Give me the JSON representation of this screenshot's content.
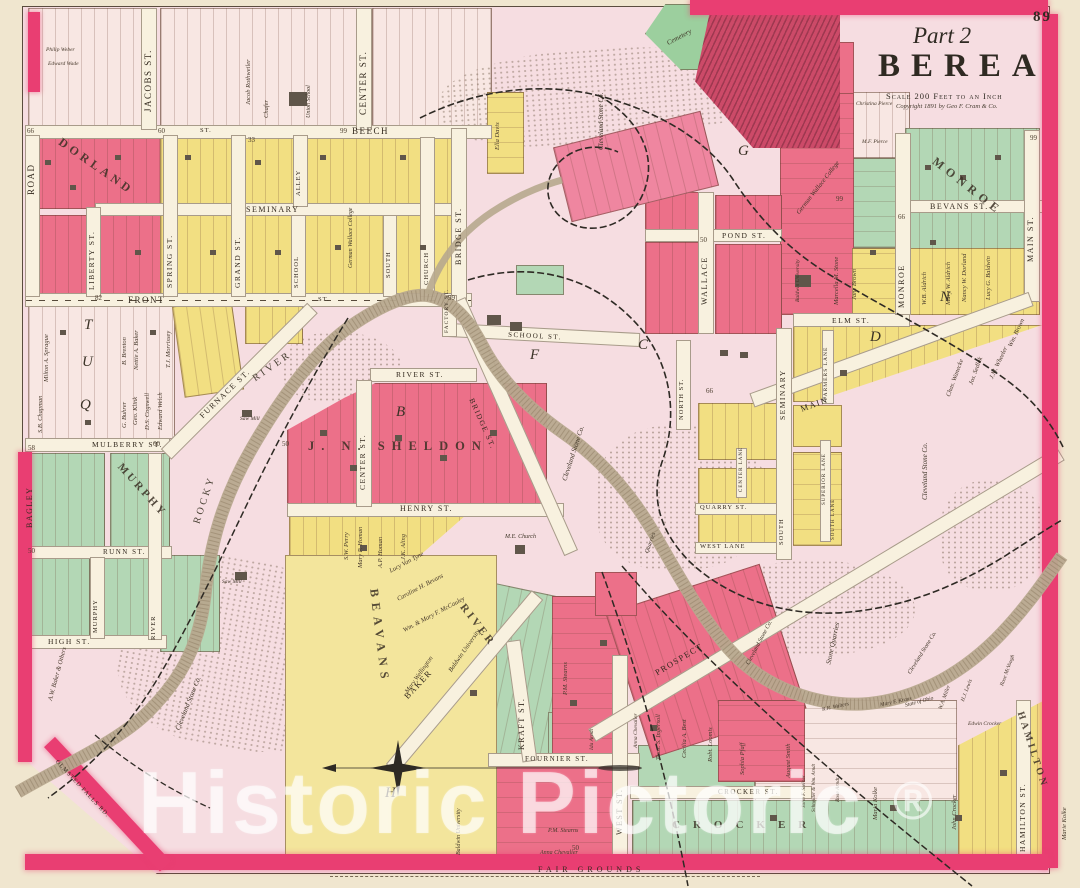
{
  "title_block": {
    "page_number": "89",
    "part": "Part 2",
    "title": "BEREA",
    "scale": "Scale 200 Feet to an Inch",
    "copyright": "Copyright 1891 by Geo F. Cram & Co."
  },
  "watermark": {
    "text": "Historic Pictoric",
    "symbol": "®"
  },
  "streets": {
    "road": "ROAD",
    "jacobs": "JACOBS ST.",
    "center": "CENTER ST.",
    "beech": "BEECH",
    "st": "ST.",
    "front": "FRONT",
    "liberty": "LIBERTY ST.",
    "spring": "SPRING ST.",
    "grand": "GRAND ST.",
    "seminary": "SEMINARY",
    "alley": "ALLEY",
    "school": "SCHOOL",
    "church": "CHURCH",
    "south": "SOUTH",
    "bridge": "BRIDGE ST.",
    "river_st": "RIVER ST.",
    "henry": "HENRY ST.",
    "furnace": "FURNACE ST.",
    "mulberry": "MULBERRY ST.",
    "bagley": "BAGLEY",
    "runn": "RUNN ST.",
    "murphy": "MURPHY",
    "river": "RIVER",
    "high": "HIGH ST.",
    "wallace": "WALLACE",
    "pond": "POND ST.",
    "bevans": "BEVANS ST.",
    "main": "MAIN ST.",
    "main_diag": "MAIN",
    "monroe": "MONROE",
    "elm": "ELM ST.",
    "farmers_lane": "FARMERS LANE",
    "north": "NORTH ST.",
    "superior_lane": "SUPERIOR LANE",
    "south_lane": "SOUTH LANE",
    "center_lane": "CENTER LANE",
    "quarry": "QUARRY ST.",
    "west_lane": "WEST LANE",
    "school_st": "SCHOOL ST.",
    "factory": "FACTORY ST.",
    "baker": "BAKER",
    "kraft": "KRAFT ST.",
    "fournier": "FOURNIER ST.",
    "west": "WEST ST.",
    "prospect": "PROSPECT",
    "crocker": "CROCKER ST.",
    "hamilton": "HAMILTON ST.",
    "olmsted": "OLMSTED FALLS RD.",
    "fair_grounds": "FAIR GROUNDS"
  },
  "subdivisions": {
    "dorland": "DORLAND",
    "sheldon": "J. N. SHELDON",
    "beavans": "BEAVANS",
    "monroe": "MONROE",
    "murphy": "MURPHY",
    "river": "RIVER",
    "crocker": "CROCKER",
    "hamilton": "HAMILTON"
  },
  "features": {
    "cemetery": "Cemetery",
    "cleveland_stone": "Cleveland Stone Co.",
    "quarries": "Quarries",
    "stone_quarries": "Stone Quarries",
    "rocky": "ROCKY",
    "river": "RIVER",
    "saw_mill": "Saw Mill",
    "union_school": "Union School",
    "german_wallace": "German Wallace College",
    "baldwin": "Baldwin University",
    "me_church": "M.E. Church",
    "state_of_ohio": "State of Ohio"
  },
  "owners": {
    "philip_weber": "Philip Weber",
    "edward_wade": "Edward Wade",
    "jacob_rothweiler": "Jacob Rothweiler",
    "chafer": "Chafer",
    "ella_davis": "Ella Davis",
    "milton_sprague": "Milton A. Sprague",
    "sb_chapman": "S.B. Chapman",
    "g_buhrer": "G. Buhrer",
    "geo_klink": "Geo. Klink",
    "ds_cogswell": "D.S. Cogswell",
    "edward_welch": "Edward Welch",
    "nettie_baker": "Nettie A. Baker",
    "b_brenton": "B. Brenton",
    "tj_morrissey": "T.J. Morrissey",
    "jane_brown": "Jane Brown",
    "marcella_stone": "Marcella M. Stone",
    "wb_aldrich": "W.B. Aldrich",
    "mary_aldrich": "Mary W. Aldrich",
    "nancy_dorland": "Nancy W. Dorland",
    "lucy_baldwin": "Lucy G. Baldwin",
    "christina_pierce": "Christina Pierce",
    "mf_pierce": "M.F. Pierce",
    "wm_brown": "Wm. Brown",
    "jm_wheeler": "J.M. Wheeler",
    "jos_sedlak": "Jos. Sedlak",
    "chas_wanecke": "Chas. Wanecke",
    "sw_perry": "S.W. Perry",
    "mary_homan": "Mary P. Homan",
    "ap_homan": "A.P. Homan",
    "jk_aling": "J.K. Aling",
    "lucy_vantyne": "Lucy Van Tyne",
    "caroline_bevans": "Caroline H. Bevans",
    "mccauley": "Wm. & Mary F. McCauley",
    "mary_wellington": "Mary Wellington",
    "pm_stearns": "P.M. Stearns",
    "anna_chevalier": "Anna Chevalier",
    "ida_arndt": "Ida Arndt",
    "thos_ingersoll": "Thos. S. Ingersoll",
    "cecilia_best": "Cecilia A. Best",
    "robt_loomis": "Robt. Loomis",
    "sophia_pfaff": "Sophia Pfaff",
    "august_smith": "August Smith",
    "john_steiner": "John F. Steiner",
    "schneider_arndt": "Schneider & Wm. Arndt",
    "rose_arndt": "Rose Arndt",
    "maria_kolke": "Maria Kolke",
    "marie_kolke": "Marie Kolke",
    "john_crocker": "John Crocker",
    "edwin_crocker": "Edwin Crocker",
    "wa_miller": "W.A. Miller",
    "hj_lewis": "H.J. Lewis",
    "rose_mcvough": "Rose McVough",
    "mary_kraus": "Mary F. Kraus",
    "rr_walters": "R.R. Walters",
    "aw_baker": "A.W. Baker & Others"
  },
  "numbers": {
    "n99": "99",
    "n66": "66",
    "n60": "60",
    "n58": "58",
    "n50": "50",
    "n33": "33",
    "n82": "82"
  },
  "letters": {
    "b": "B",
    "c": "C",
    "d": "D",
    "f": "F",
    "g": "G",
    "h": "H",
    "n": "N",
    "q": "Q",
    "t": "T",
    "u": "U"
  }
}
